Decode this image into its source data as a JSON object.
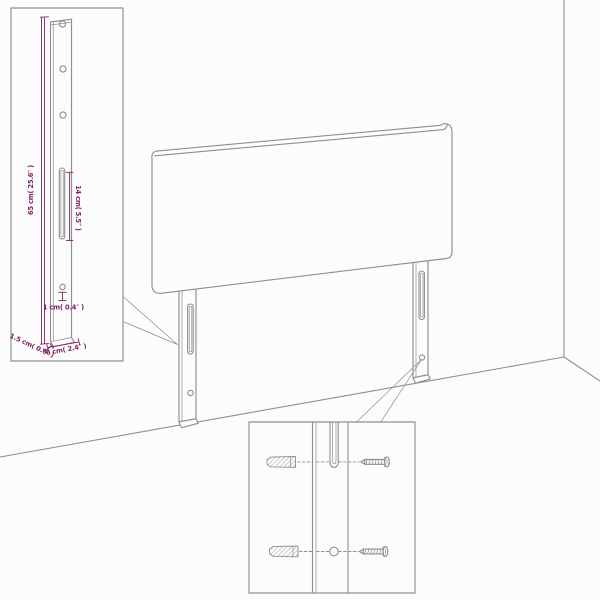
{
  "colors": {
    "background": "#fcfcfc",
    "drawing_line": "#8f8f8f",
    "dimension": "#7d2362"
  },
  "leg_detail_inset": {
    "height_label": "65 cm( 25.6″ )",
    "slot_length_label": "14 cm( 5.5″ )",
    "hole_offset_label": "1 cm( 0.4″ )",
    "thickness_label": "1.5 cm( 0.6″ )",
    "width_label": "6 cm( 2.4″ )"
  },
  "hardware_detail_inset": {
    "wall_plug_icon": "wall-plug-icon",
    "screw_icon": "screw-icon"
  }
}
